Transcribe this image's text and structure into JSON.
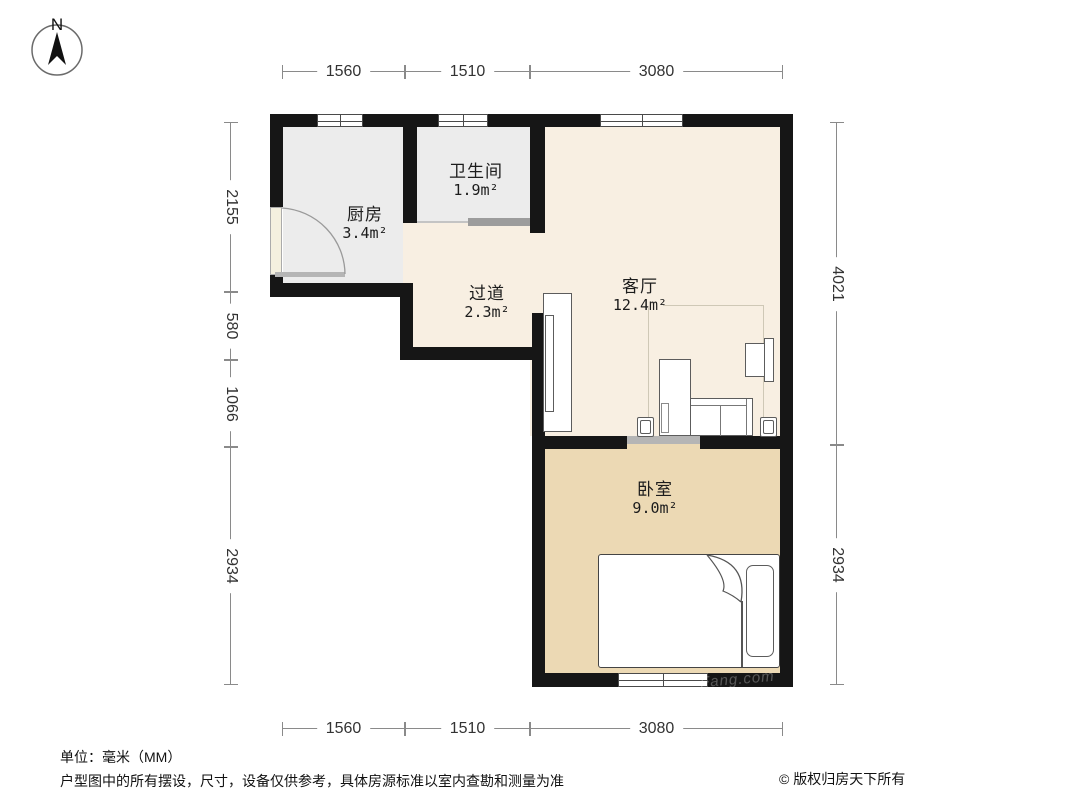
{
  "compass": {
    "label": "N"
  },
  "dimensions": {
    "unit": "mm",
    "top": [
      "1560",
      "1510",
      "3080"
    ],
    "bottom": [
      "1560",
      "1510",
      "3080"
    ],
    "left": [
      "2155",
      "580",
      "1066",
      "2934"
    ],
    "right": [
      "4021",
      "2934"
    ]
  },
  "rooms": {
    "kitchen": {
      "name": "厨房",
      "area": "3.4",
      "unit": "m²"
    },
    "bathroom": {
      "name": "卫生间",
      "area": "1.9",
      "unit": "m²"
    },
    "hallway": {
      "name": "过道",
      "area": "2.3",
      "unit": "m²"
    },
    "living": {
      "name": "客厅",
      "area": "12.4",
      "unit": "m²"
    },
    "bedroom": {
      "name": "卧室",
      "area": "9.0",
      "unit": "m²"
    }
  },
  "footer": {
    "unit_note": "单位：毫米（MM）",
    "disclaimer": "户型图中的所有摆设，尺寸，设备仅供参考，具体房源标准以室内查勘和测量为准",
    "copyright": "© 版权归房天下所有"
  },
  "watermark": "Fang.com",
  "colors": {
    "wall": "#161616",
    "kitchen_bath_floor": "#ececec",
    "living_hall_floor": "#f8efe2",
    "bedroom_floor": "#ecd9b4",
    "dimension_line": "#8a8a8a"
  }
}
